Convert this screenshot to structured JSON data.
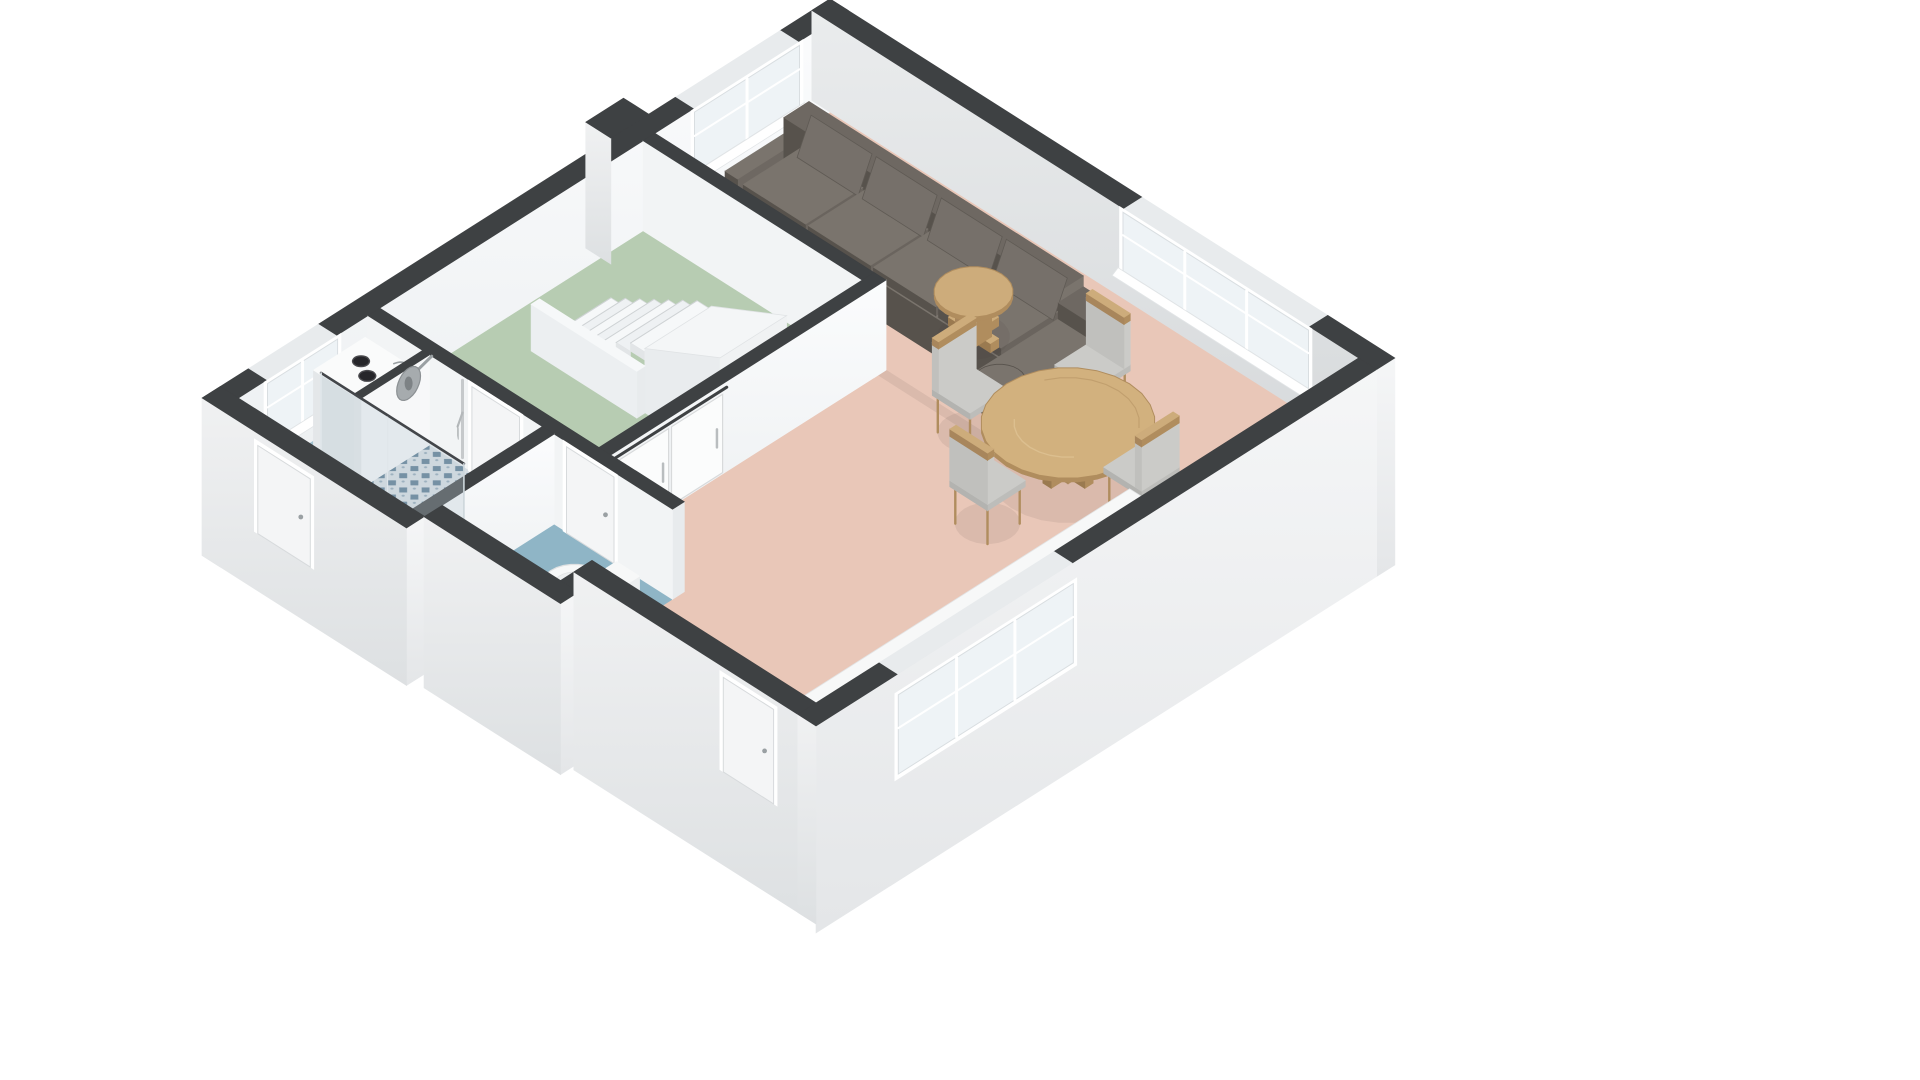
{
  "meta": {
    "title": "3D Floor Plan — Ground Floor",
    "description": "Isometric cutaway 3D floor plan showing a living room with kitchen, dining set, sofa, hall with staircase, bathroom with shower and washing machine, and a separate toilet room",
    "background": "#ffffff"
  },
  "palette": {
    "wallTop": "#3e4143",
    "wallTopLight": "#e8ebed",
    "faceWhite": "#f8fafb",
    "faceLight": "#eff1f2",
    "faceGray": "#dfe2e4",
    "floorLiving": "#e9c7b8",
    "floorHall": "#b7ccb2",
    "floorBath": "#a2c2cf",
    "floorToilet": "#8fb5c6",
    "tileBase": "#d8dfe4",
    "tileDiamond": "#54768e",
    "graniteBase": "#322e2a",
    "graniteSpeck": "#4a443c",
    "counterWhite": "#f7f8f8",
    "wood": "#cdac7b",
    "woodDark": "#b08d5e",
    "woodLight": "#e0c597",
    "sofaBase": "#6e6862",
    "sofaCushion": "#7a746d",
    "sofaDark": "#57524c",
    "chairSeat": "#cbcbc8",
    "steel": "#c3c7c9",
    "steelDark": "#8e9396",
    "stoveBody": "#8c8179",
    "stoveDark": "#564f49",
    "glassFill": "rgba(186,203,213,0.32)",
    "glassEdge": "#43464a",
    "shadow": "rgba(70,60,50,0.09)"
  },
  "rooms": [
    {
      "id": "living-room",
      "label": "Living room / kitchen / dining",
      "floor": "floorLiving",
      "layer": 0,
      "poly": [
        [
          0,
          0
        ],
        [
          7.55,
          0
        ],
        [
          7.55,
          7.75
        ],
        [
          4.35,
          7.75
        ],
        [
          4.35,
          6.6
        ],
        [
          3.3,
          6.6
        ],
        [
          3.3,
          2.5
        ],
        [
          0,
          2.5
        ]
      ]
    },
    {
      "id": "hall",
      "label": "Hall with staircase",
      "floor": "floorHall",
      "layer": 0,
      "poly": [
        [
          0,
          2.67
        ],
        [
          3.13,
          2.67
        ],
        [
          3.13,
          6.43
        ],
        [
          0,
          6.43
        ]
      ]
    },
    {
      "id": "bathroom",
      "label": "Bathroom with shower",
      "floor": "floorBath",
      "layer": 0,
      "poly": [
        [
          0,
          6.6
        ],
        [
          2.49,
          6.6
        ],
        [
          2.49,
          8.45
        ],
        [
          0,
          8.45
        ]
      ]
    },
    {
      "id": "shower-floor",
      "label": "Tiled shower floor",
      "floor": "tile",
      "layer": 0.1,
      "poly": [
        [
          0.88,
          6.6
        ],
        [
          2.49,
          6.6
        ],
        [
          2.49,
          7.72
        ],
        [
          0.88,
          7.72
        ]
      ]
    },
    {
      "id": "toilet-room",
      "label": "Toilet room",
      "floor": "floorToilet",
      "layer": 0,
      "poly": [
        [
          2.66,
          6.6
        ],
        [
          4.35,
          6.6
        ],
        [
          4.35,
          8.2
        ],
        [
          2.66,
          8.2
        ]
      ]
    }
  ],
  "walls": [
    {
      "id": "wall-exterior-left",
      "layer": 1,
      "x1": -0.26,
      "y1": -0.26,
      "x2": 0,
      "y2": 8.71,
      "faceX": "gFaceX",
      "faceY": "gExtY",
      "zBotY": -0.75,
      "lightSpans": [
        [
          0.45,
          1.95
        ],
        [
          7.05,
          8.05
        ]
      ]
    },
    {
      "id": "wall-exterior-top",
      "layer": 1.1,
      "x1": -0.26,
      "y1": -0.26,
      "x2": 7.81,
      "y2": 0,
      "faceY": "gFaceY",
      "faceX": "gExtX",
      "zBotX": -1.3,
      "lightSpans": [
        [
          4.2,
          6.85
        ]
      ]
    },
    {
      "id": "pilaster-top-left",
      "layer": 1.3,
      "x1": -0.62,
      "y1": 2.33,
      "x2": -0.26,
      "y2": 2.87,
      "faceX": "none",
      "faceY": "gExtY",
      "zBotY": -0.4
    },
    {
      "id": "wall-hall-north",
      "layer": 3,
      "x1": 0,
      "y1": 2.5,
      "x2": 3.3,
      "y2": 2.67,
      "faceY": "#f2f4f5",
      "faceX": "#eaedee"
    },
    {
      "id": "wall-hall-east",
      "layer": 5,
      "x1": 3.13,
      "y1": 2.5,
      "x2": 3.3,
      "y2": 6.6,
      "faceX": "gFaceX",
      "faceY": "#e4e7e9"
    },
    {
      "id": "wall-bath-north",
      "layer": 6,
      "x1": 0,
      "y1": 6.43,
      "x2": 4.35,
      "y2": 6.6,
      "faceY": "#f2f4f5",
      "faceX": "#e8ebed"
    },
    {
      "id": "wall-shower-partition",
      "layer": 7.1,
      "x1": 0.78,
      "y1": 6.6,
      "x2": 0.88,
      "y2": 7.58,
      "faceX": "#f7f8f9",
      "faceY": "#e6e9eb"
    },
    {
      "id": "wall-bath-toilet",
      "layer": 8,
      "x1": 2.49,
      "y1": 6.6,
      "x2": 2.66,
      "y2": 8.45,
      "faceX": "gFaceX",
      "faceY": "#e4e7e9"
    },
    {
      "id": "wall-wing-south",
      "layer": 13,
      "x1": -0.26,
      "y1": 8.45,
      "x2": 2.66,
      "y2": 8.71,
      "faceY": "gExtY",
      "faceX": "gExtX",
      "zBotY": -0.75,
      "zBotX": -0.75
    },
    {
      "id": "wall-toilet-south",
      "layer": 13.05,
      "x1": 2.66,
      "y1": 8.2,
      "x2": 4.61,
      "y2": 8.46,
      "faceY": "gExtY",
      "faceX": "gExtX",
      "zBotY": -0.9,
      "zBotX": -0.9
    },
    {
      "id": "wall-toilet-east",
      "layer": 13.1,
      "x1": 4.35,
      "y1": 7.75,
      "x2": 4.61,
      "y2": 8.2,
      "faceX": "gExtX",
      "faceY": "none",
      "zBotX": -0.9
    },
    {
      "id": "wall-living-south",
      "layer": 13.15,
      "x1": 4.35,
      "y1": 7.75,
      "x2": 7.81,
      "y2": 8.01,
      "faceY": "gExtY",
      "faceX": "none",
      "zBotY": -1.2
    },
    {
      "id": "wall-kitchen-east",
      "layer": 13.3,
      "x1": 7.55,
      "y1": 0,
      "x2": 7.81,
      "y2": 8.01,
      "faceX": "gExtX",
      "faceY": "gExtY",
      "zBotX": -1.3,
      "zBotY": -1.2,
      "lightSpans": [
        [
          4.35,
          6.85
        ]
      ]
    }
  ],
  "openings": [
    {
      "id": "window-living-left",
      "type": "window",
      "layer": 1.2,
      "plane": "x",
      "coord": 0.015,
      "from": 0.45,
      "to": 1.95,
      "z1": 0.3,
      "z2": 0.97,
      "mullions": 1,
      "sill": true
    },
    {
      "id": "window-bath-left",
      "type": "window",
      "layer": 1.2,
      "plane": "x",
      "coord": 0.015,
      "from": 7.05,
      "to": 8.05,
      "z1": 0.3,
      "z2": 0.97,
      "mullions": 1,
      "sill": true
    },
    {
      "id": "window-living-top",
      "type": "window",
      "layer": 1.2,
      "plane": "y",
      "coord": 0.015,
      "from": 4.2,
      "to": 6.85,
      "z1": 0.32,
      "z2": 0.97,
      "mullions": 2,
      "sill": true
    },
    {
      "id": "window-kitchen",
      "type": "window",
      "layer": 13.5,
      "plane": "x",
      "coord": 7.825,
      "from": 4.35,
      "to": 6.85,
      "z1": -0.1,
      "z2": 0.78,
      "mullions": 2,
      "sill": false
    },
    {
      "id": "door-bathroom",
      "type": "door",
      "layer": 6.2,
      "plane": "y",
      "coord": 6.615,
      "from": 1.5,
      "to": 2.18,
      "z1": 0,
      "z2": 0.96
    },
    {
      "id": "door-toilet",
      "type": "door",
      "layer": 6.2,
      "plane": "y",
      "coord": 6.615,
      "from": 2.85,
      "to": 3.53,
      "z1": 0,
      "z2": 0.96
    },
    {
      "id": "door-front",
      "type": "door",
      "layer": 13.2,
      "plane": "y",
      "coord": 8.025,
      "from": 6.5,
      "to": 7.22,
      "z1": -0.15,
      "z2": 0.9
    },
    {
      "id": "door-back",
      "type": "door",
      "layer": 13.2,
      "plane": "y",
      "coord": 8.725,
      "from": 0.55,
      "to": 1.3,
      "z1": -0.1,
      "z2": 0.88
    },
    {
      "id": "sliding-doors-hall",
      "type": "sliding",
      "layer": 5.2,
      "coord": 3.315,
      "panels": [
        [
          4.85,
          5.58
        ],
        [
          5.62,
          6.35
        ]
      ],
      "railZ": 0.95,
      "height": 0.9
    }
  ],
  "furniture": [
    {
      "id": "sofa",
      "type": "sofa",
      "layer": 2
    },
    {
      "id": "side-table",
      "type": "round-table",
      "layer": 2.5,
      "center": [
        3.55,
        1.5
      ],
      "radius": 0.4,
      "topZ": 0.5,
      "style": "side"
    },
    {
      "id": "staircase",
      "type": "stairs",
      "layer": 4,
      "x0": 0.62,
      "stepCount": 7,
      "stepDepth": 0.205,
      "stepRise": 0.096,
      "y1": 3.75,
      "y2": 4.7,
      "rampX2": 3.13,
      "rampTopZ": 1.14,
      "balustrade": {
        "x1": 0.55,
        "x2": 2.06,
        "y1": 4.7,
        "y2": 4.82,
        "height": 0.52
      }
    },
    {
      "id": "washing-machine",
      "type": "washer",
      "layer": 7,
      "x1": 0.08,
      "y1": 6.72,
      "x2": 0.74,
      "y2": 7.46,
      "height": 0.86
    },
    {
      "id": "shower",
      "type": "shower",
      "layer": 7.2,
      "headCenter": [
        0.93,
        6.95
      ],
      "headZ": 0.88,
      "headR": 0.17,
      "poleX": 1.38
    },
    {
      "id": "toilet",
      "type": "toilet",
      "layer": 9,
      "center": [
        3.7,
        7.35
      ],
      "radius": 0.34,
      "tank": {
        "x1": 3.95,
        "y1": 7.0,
        "x2": 4.28,
        "y2": 7.7,
        "h": 0.42
      }
    },
    {
      "id": "shower-glass",
      "type": "glass-screen",
      "layer": 10,
      "x1": 0.45,
      "x2": 2.49,
      "y": 7.72,
      "height": 1.14
    },
    {
      "id": "dining-chair-back",
      "type": "chair",
      "layer": 11,
      "center": [
        5.2,
        1.45
      ],
      "facing": "+y"
    },
    {
      "id": "dining-chair-left",
      "type": "chair",
      "layer": 11,
      "center": [
        4.6,
        2.6
      ],
      "facing": "+x"
    },
    {
      "id": "dining-table",
      "type": "round-table",
      "layer": 11.3,
      "center": [
        5.75,
        2.35
      ],
      "radius": 0.88,
      "topZ": 0.55,
      "style": "dining"
    },
    {
      "id": "dining-chair-right",
      "type": "chair",
      "layer": 11.6,
      "center": [
        6.7,
        2.25
      ],
      "facing": "-x"
    },
    {
      "id": "dining-chair-front",
      "type": "chair",
      "layer": 11.6,
      "center": [
        5.75,
        3.5
      ],
      "facing": "-y"
    },
    {
      "id": "kitchen-counter",
      "type": "counter",
      "layer": 12,
      "x1": 6.9,
      "y1": 2.62,
      "x2": 7.55,
      "y2": 7.48,
      "topZ": 0.52
    },
    {
      "id": "stove",
      "type": "stove",
      "layer": 12.1,
      "x1": 7.16,
      "y1": 2.98,
      "x2": 7.54,
      "y2": 3.94
    },
    {
      "id": "sink",
      "type": "sink",
      "layer": 12.1,
      "x1": 7.19,
      "y1": 4.88,
      "x2": 7.53,
      "y2": 5.62
    }
  ]
}
